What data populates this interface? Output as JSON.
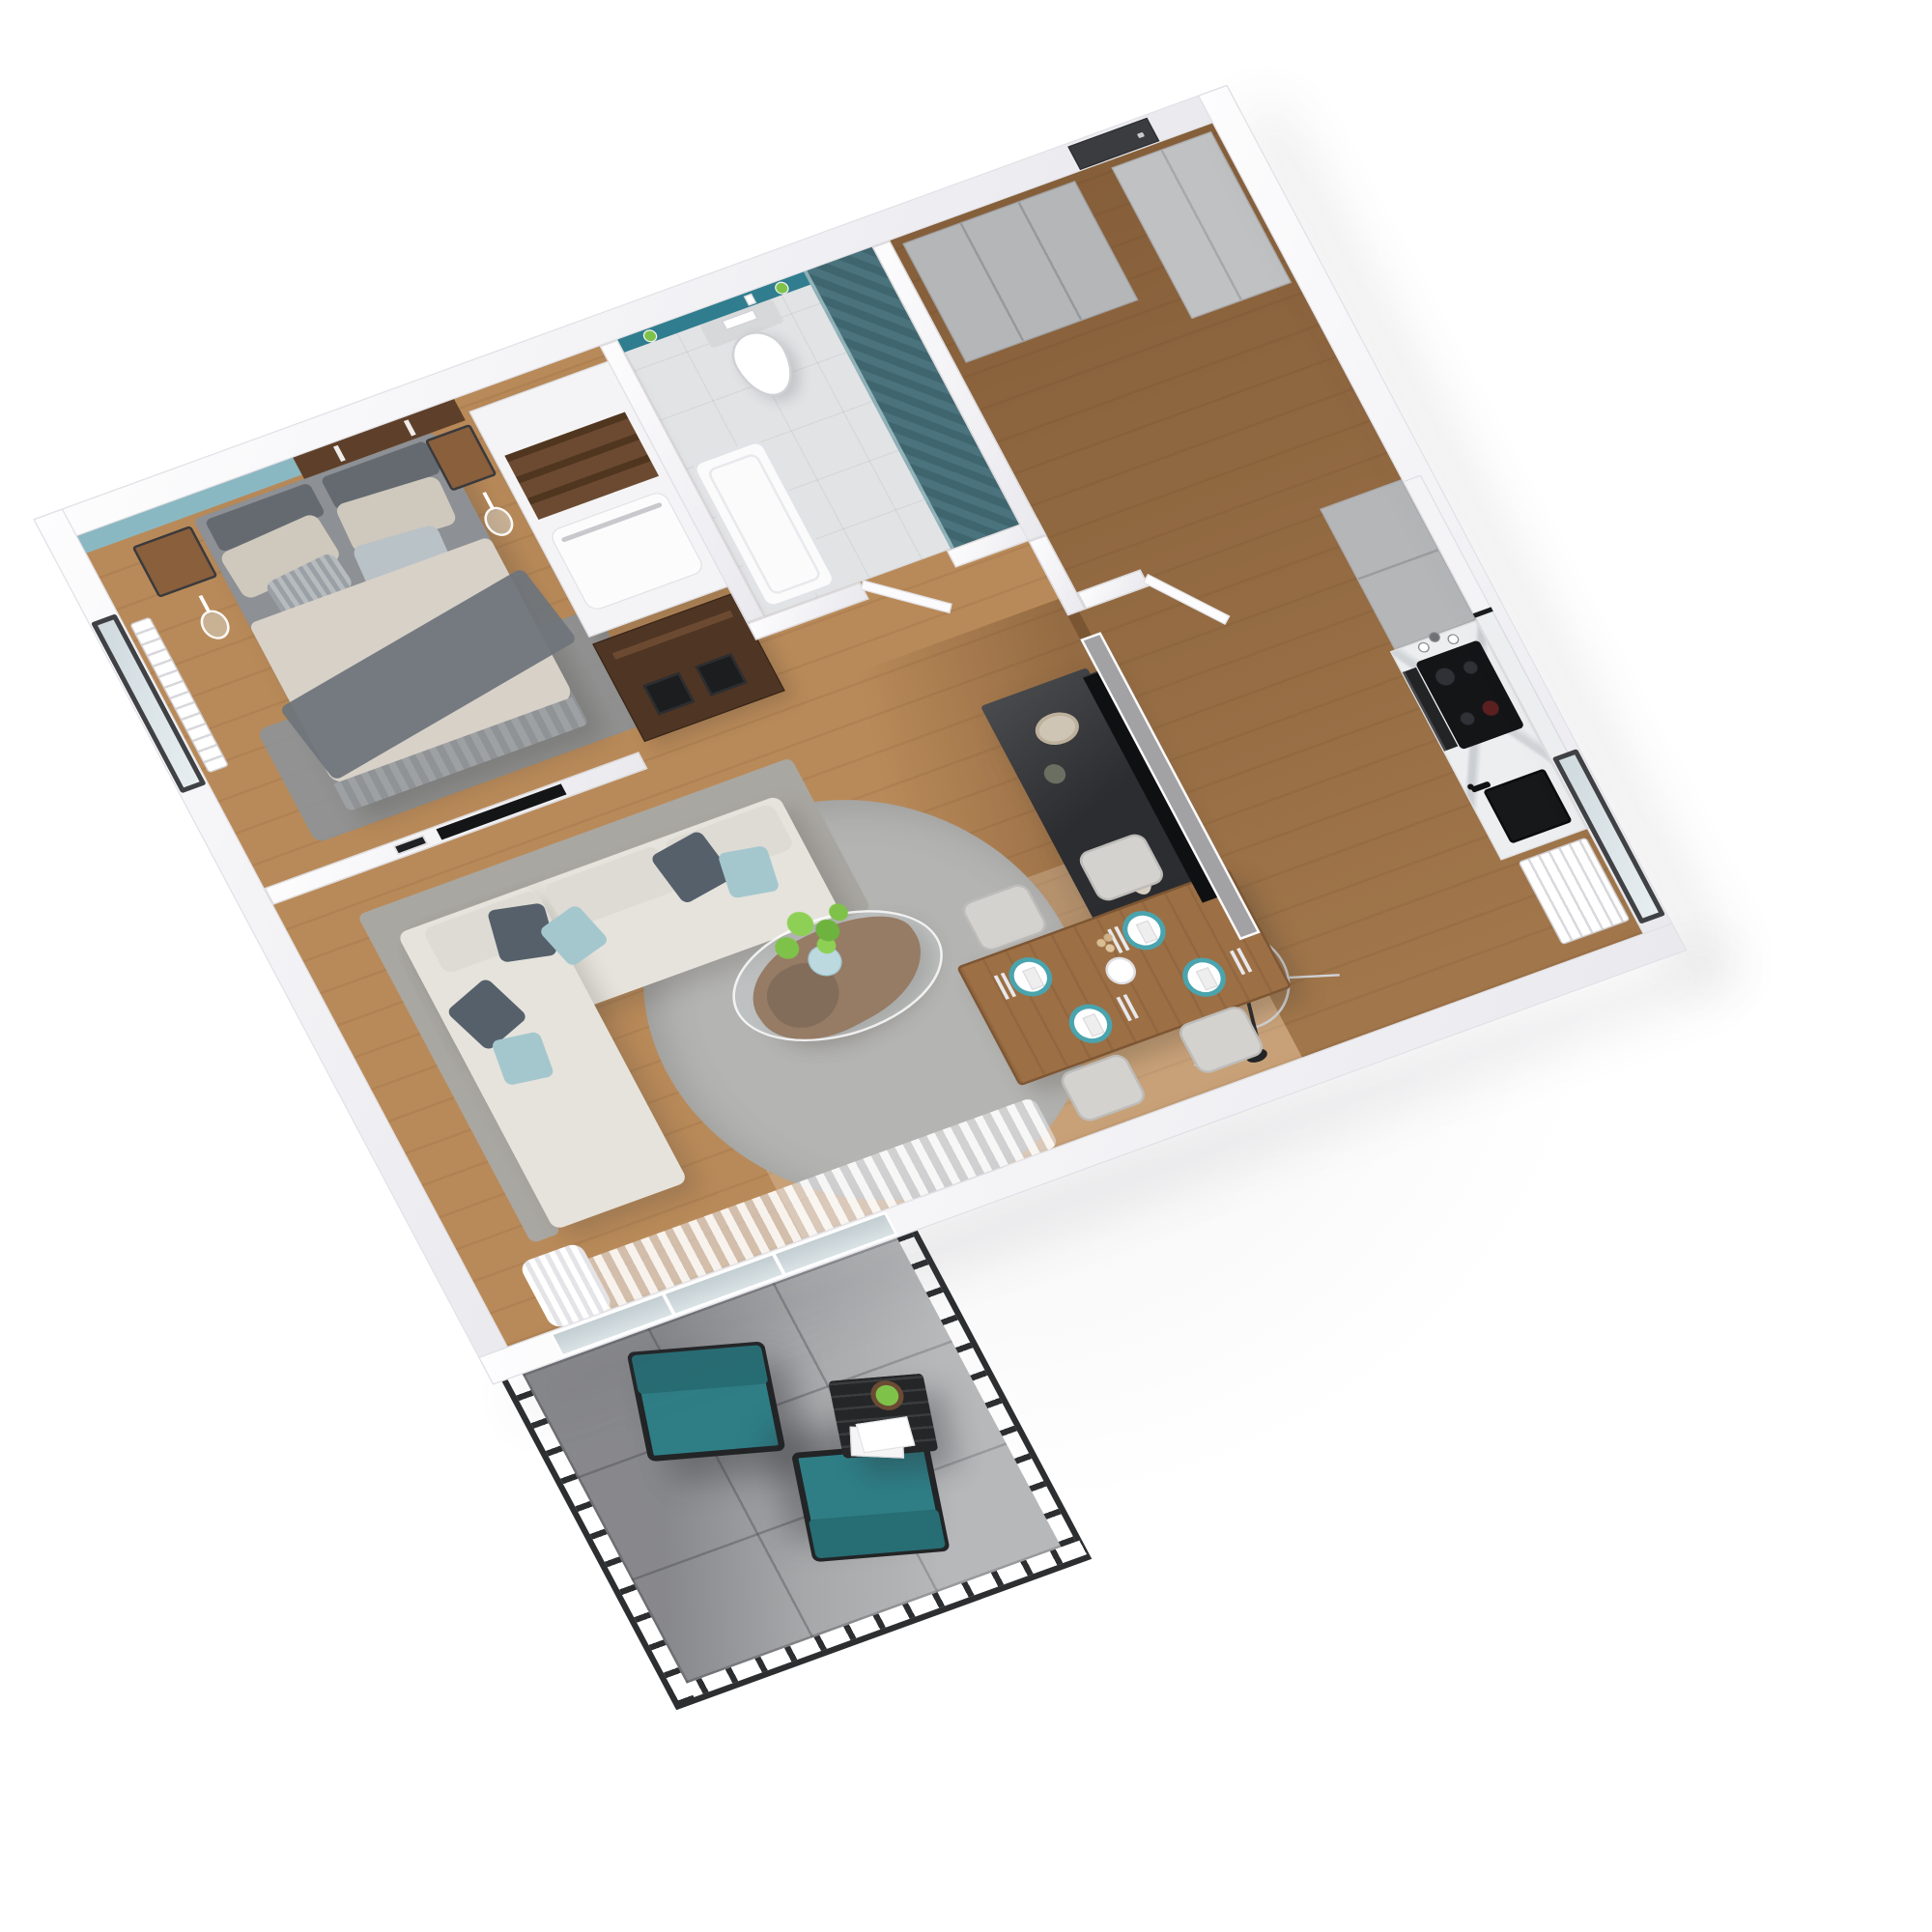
{
  "palette": {
    "background": "#ffffff",
    "wall": "#f2f2f4",
    "woodFloor": "#b98a59",
    "tileFloor": "#e2e3e5",
    "balconyTile": "#a7a8aa",
    "tealWall": "#8ab8c2",
    "tealNiche": "#2f7d8e",
    "tealTile": "#4a737d",
    "accentTeal": "#2f7e86",
    "accentTealDark": "#276d74",
    "headboardWood": "#5e402a",
    "darkWood": "#4f3524",
    "coffeeWood": "#7a4f2e",
    "bedBase": "#8d9094",
    "bedLinen": "#d8d1c8",
    "throwGray": "#6f757b",
    "pillowBeige": "#cfc8bd",
    "bedroomRug": "#8d9296",
    "sofaCream": "#e6e3dc",
    "sofaGray": "#a9a7a2",
    "pillowNavy": "#55606b",
    "pillowTeal": "#a4c7ce",
    "rugGray": "#b4b4b2",
    "furnitureBlack": "#2b2d30",
    "partitionGray": "#a2a2a5",
    "grayCabinet": "#b5b6b8",
    "marble": "#eceef0",
    "tableWood": "#9c6f45",
    "plateTeal": "#4aa4ae",
    "plantGreen": "#7fc24a",
    "vaseBlue": "#bcd9e0",
    "railing": "#2c2e30",
    "entryDoor": "#3a3c3f"
  },
  "floorplan": {
    "view": "isometric-3d-top",
    "rooms": [
      {
        "id": "bedroom",
        "furniture": [
          "double-bed",
          "headboard-panel",
          "teal-accent-wall",
          "nightstand-left",
          "nightstand-right",
          "pendant-lamp-left",
          "pendant-lamp-right",
          "radiator",
          "window",
          "wardrobe",
          "open-shelf-dresser",
          "area-rug",
          "wall-tv-niche",
          "picture-frame"
        ]
      },
      {
        "id": "bathroom",
        "furniture": [
          "wall-hung-toilet",
          "flush-plate",
          "teal-niche-shelf",
          "potted-cactus",
          "reed-diffuser",
          "bathtub",
          "teal-herringbone-shower",
          "bathroom-door"
        ]
      },
      {
        "id": "hallway",
        "furniture": [
          "entry-door",
          "gray-wardrobe-cabinets",
          "tall-gray-cabinet",
          "interior-door"
        ]
      },
      {
        "id": "kitchen",
        "furniture": [
          "tall-cabinets",
          "marble-counter",
          "induction-cooktop",
          "oven",
          "black-sink",
          "black-faucet",
          "mugs",
          "upper-cabinets",
          "marble-backsplash",
          "radiator",
          "window"
        ]
      },
      {
        "id": "living-room",
        "furniture": [
          "l-shaped-sofa",
          "throw-pillows",
          "round-rug",
          "organic-wood-coffee-table",
          "glass-table-top",
          "blue-vase-with-plant",
          "tv-partition-wall",
          "tv-screen",
          "black-media-sideboard",
          "decor-bowl",
          "decor-bottle",
          "decor-vase",
          "wireframe-floor-lamp",
          "sheer-curtains",
          "balcony-glass-door"
        ]
      },
      {
        "id": "dining-area",
        "furniture": [
          "wood-dining-table",
          "dining-chair-1",
          "dining-chair-2",
          "dining-chair-3",
          "dining-chair-4",
          "teal-rim-place-settings",
          "cutlery",
          "centerpiece-vase",
          "dried-stems"
        ]
      },
      {
        "id": "balcony",
        "furniture": [
          "black-metal-railing",
          "teal-lounge-chair-1",
          "teal-lounge-chair-2",
          "black-side-table",
          "potted-plant",
          "magazines",
          "gray-tile-floor"
        ]
      }
    ]
  }
}
